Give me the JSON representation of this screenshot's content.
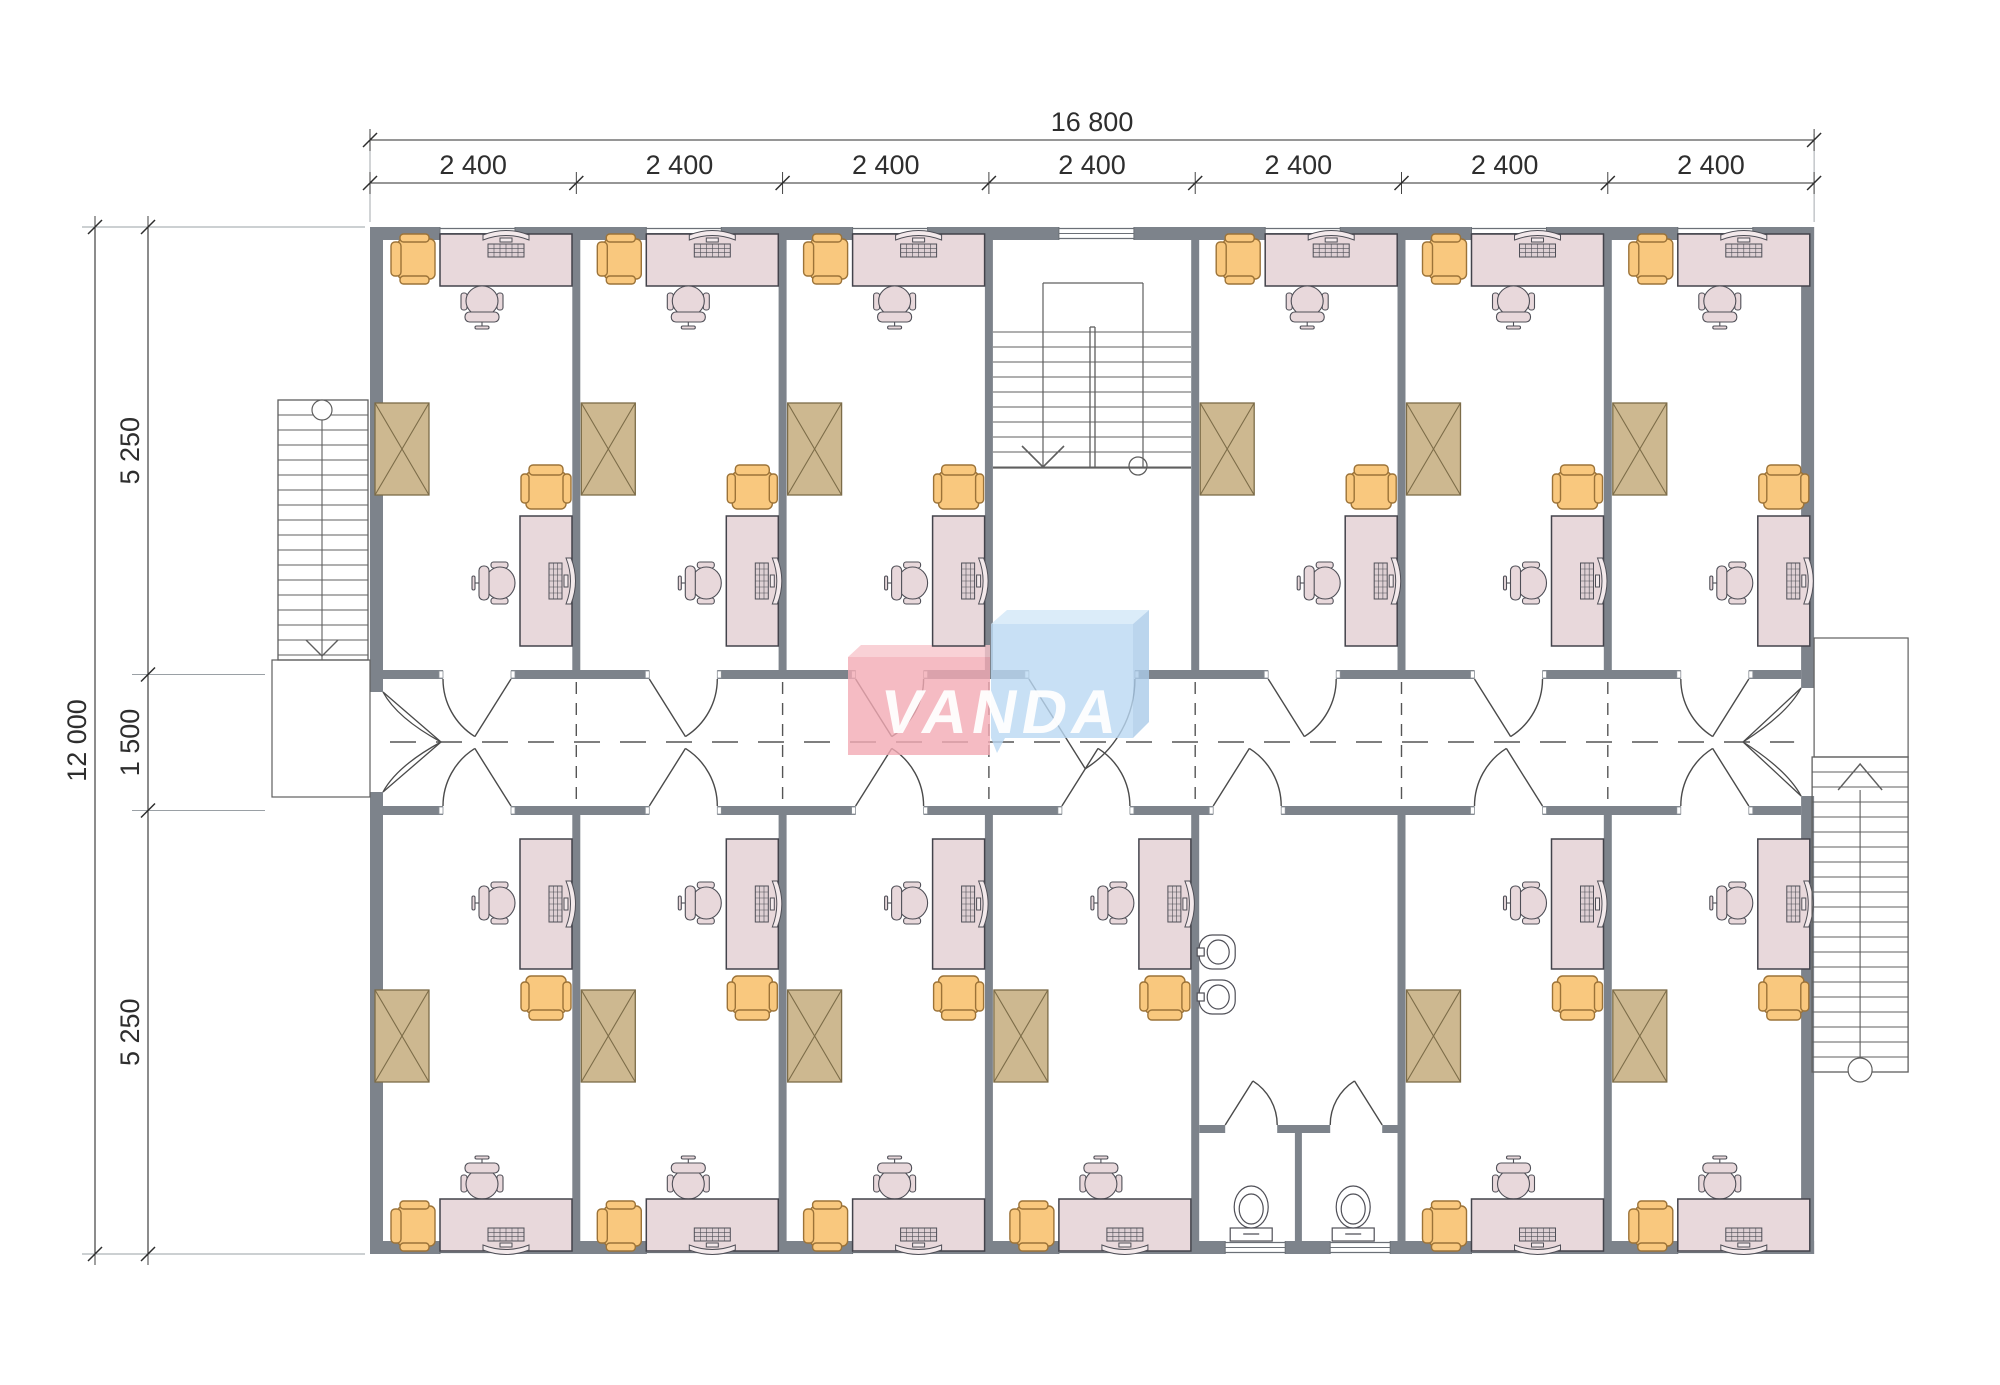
{
  "drawing": {
    "title": "Office floor plan",
    "brand": {
      "text": "VANDA"
    },
    "dimensions": {
      "top_total": "16 800",
      "top_bays": [
        "2 400",
        "2 400",
        "2 400",
        "2 400",
        "2 400",
        "2 400",
        "2 400"
      ],
      "left_total": "12 000",
      "left_segments": [
        "5 250",
        "1 500",
        "5 250"
      ]
    },
    "rooms": {
      "top": [
        "office",
        "office",
        "office",
        "stairwell",
        "office",
        "office",
        "office"
      ],
      "bottom": [
        "office",
        "office",
        "office",
        "office",
        "sanitary",
        "office",
        "office"
      ]
    },
    "door_flips": {
      "top": [
        true,
        false,
        false,
        false,
        false,
        false,
        true
      ],
      "bottom": [
        true,
        false,
        false,
        false,
        false,
        true,
        true
      ]
    },
    "fixtures": {
      "office": [
        "desk",
        "computer",
        "office-chair",
        "armchair",
        "wardrobe"
      ],
      "sanitary": [
        "washbasin",
        "washbasin",
        "toilet",
        "toilet"
      ],
      "stairwell": [
        "staircase-double-run"
      ]
    },
    "colors": {
      "wall": "#7d838b",
      "desk_fill": "#e8d8db",
      "desk_stroke": "#43434b",
      "chair_orange": "#f9c87e",
      "chair_orange_stroke": "#9c7338",
      "wardrobe_fill": "#cdb890",
      "wardrobe_stroke": "#7c6c48",
      "fixture_stroke": "#4f4f57",
      "stair": "#5f5f5f",
      "dim": "#2e2e2e",
      "dash": "#555555",
      "logo_pink": "rgba(242,170,180,0.8)",
      "logo_pink_top": "rgba(247,198,204,0.8)",
      "logo_blue": "rgba(186,216,242,0.8)",
      "logo_blue_top": "rgba(210,231,248,0.8)",
      "logo_blue_side": "rgba(170,203,233,0.8)",
      "logo_text": "#ffffff"
    }
  }
}
